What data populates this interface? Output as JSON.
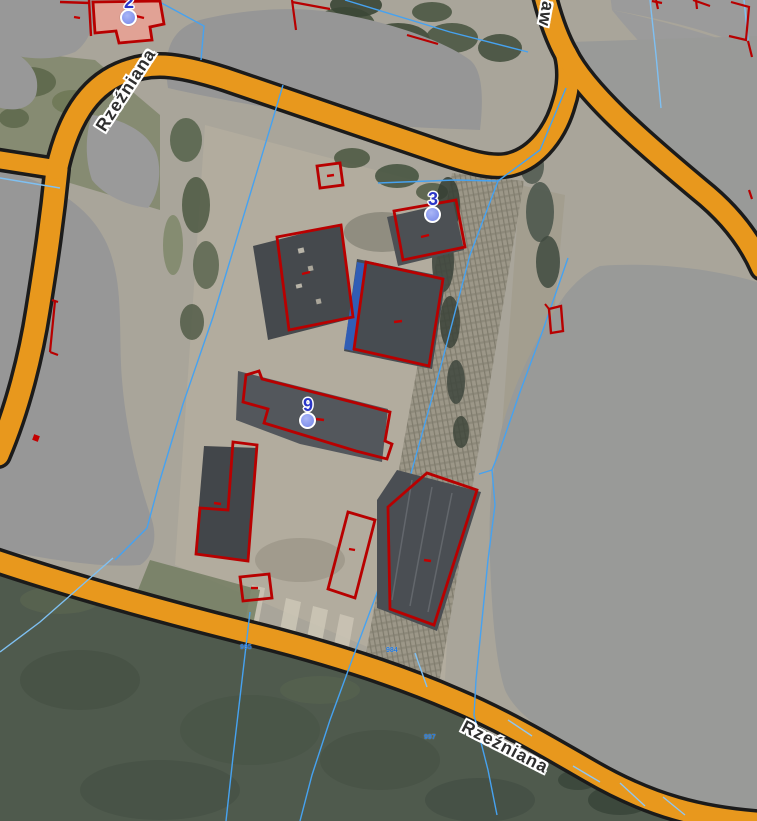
{
  "map_view": {
    "streets": [
      {
        "name": "Rzeźniana",
        "position": "top-left"
      },
      {
        "name": "Rzeźniana",
        "position": "bottom"
      },
      {
        "name": "aw",
        "position": "top-right-partial"
      }
    ],
    "building_markers": [
      {
        "number": "2"
      },
      {
        "number": "3"
      },
      {
        "number": "9"
      }
    ],
    "parcel_labels": [
      {
        "text": "995"
      },
      {
        "text": "984"
      },
      {
        "text": "997"
      }
    ],
    "legend_colors": {
      "road_fill": "#E8981D",
      "road_casing": "#1B1B1B",
      "building_outline": "#B80000",
      "highlighted_building_fill": "#EFA193",
      "parcel_line": "#46A2F0",
      "marker_fill": "#8D9EF0",
      "marker_number": "#2B36C8",
      "masked_building": "#989898"
    }
  }
}
